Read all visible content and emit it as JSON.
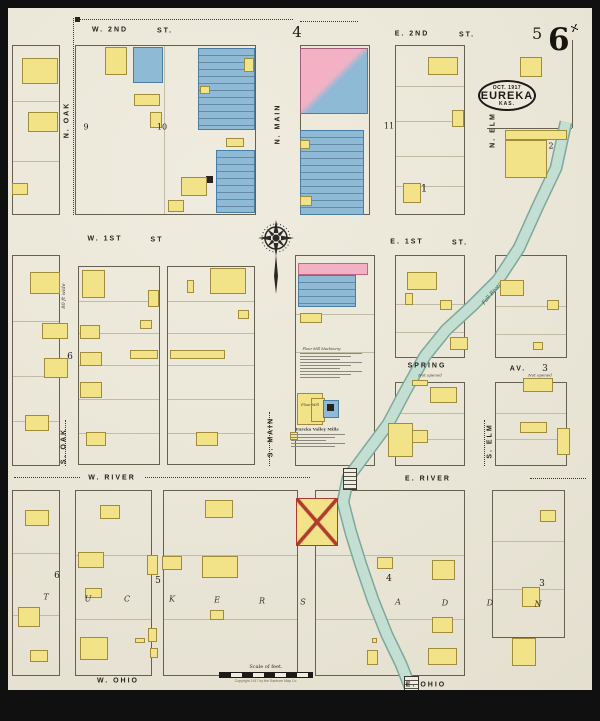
{
  "map": {
    "title_stamp": {
      "date": "OCT. 1917",
      "city": "EUREKA",
      "state": "KAS."
    },
    "sheet_number_large": "6",
    "adjacent_sheet_number": "5",
    "scale_label": "Scale of feet.",
    "copyright_line": "Copyright 1917 by the Sanborn Map Co.",
    "colors": {
      "paper": "#e9e5d6",
      "frame": "#101010",
      "frame_building": "#f2e388",
      "stone_building": "#8fbad5",
      "brick_building": "#f2b1c4",
      "river": "#c3ded2",
      "river_edge": "#7ea89a",
      "ink": "#25221b"
    },
    "streets": [
      {
        "t": "W. 2ND",
        "x": 110,
        "y": 30
      },
      {
        "t": "ST.",
        "x": 165,
        "y": 31
      },
      {
        "t": "E. 2ND",
        "x": 412,
        "y": 34
      },
      {
        "t": "ST.",
        "x": 467,
        "y": 35
      },
      {
        "t": "W. 1ST",
        "x": 105,
        "y": 239
      },
      {
        "t": "ST",
        "x": 157,
        "y": 240
      },
      {
        "t": "E. 1ST",
        "x": 407,
        "y": 242
      },
      {
        "t": "ST.",
        "x": 460,
        "y": 243
      },
      {
        "t": "SPRING",
        "x": 427,
        "y": 366
      },
      {
        "t": "AV.",
        "x": 518,
        "y": 369
      },
      {
        "t": "W. RIVER",
        "x": 112,
        "y": 478
      },
      {
        "t": "E. RIVER",
        "x": 428,
        "y": 479
      },
      {
        "t": "W. OHIO",
        "x": 118,
        "y": 681
      },
      {
        "t": "E. OHIO",
        "x": 426,
        "y": 685
      },
      {
        "t": "N. OAK",
        "x": 67,
        "y": 120,
        "v": 1
      },
      {
        "t": "N. MAIN",
        "x": 278,
        "y": 124,
        "v": 1
      },
      {
        "t": "N. ELM",
        "x": 493,
        "y": 130,
        "v": 1
      },
      {
        "t": "S. OAK",
        "x": 64,
        "y": 446,
        "v": 1
      },
      {
        "t": "S. MAIN",
        "x": 271,
        "y": 437,
        "v": 1
      },
      {
        "t": "S. ELM",
        "x": 490,
        "y": 441,
        "v": 1
      }
    ],
    "block_numbers": [
      {
        "t": "4",
        "x": 297,
        "y": 32,
        "s": 15
      },
      {
        "t": "9",
        "x": 86,
        "y": 127,
        "s": 8
      },
      {
        "t": "10",
        "x": 162,
        "y": 127,
        "s": 8
      },
      {
        "t": "11",
        "x": 389,
        "y": 126,
        "s": 8
      },
      {
        "t": "2",
        "x": 551,
        "y": 146,
        "s": 8
      },
      {
        "t": "1",
        "x": 424,
        "y": 189,
        "s": 10
      },
      {
        "t": "6",
        "x": 70,
        "y": 357,
        "s": 9
      },
      {
        "t": "3",
        "x": 545,
        "y": 369,
        "s": 9
      },
      {
        "t": "6",
        "x": 57,
        "y": 576,
        "s": 9
      },
      {
        "t": "5",
        "x": 158,
        "y": 581,
        "s": 9
      },
      {
        "t": "4",
        "x": 389,
        "y": 579,
        "s": 9
      },
      {
        "t": "3",
        "x": 542,
        "y": 584,
        "s": 9
      }
    ],
    "addition_letters": [
      {
        "t": "T",
        "x": 46,
        "y": 597
      },
      {
        "t": "U",
        "x": 88,
        "y": 599
      },
      {
        "t": "C",
        "x": 127,
        "y": 599
      },
      {
        "t": "K",
        "x": 172,
        "y": 599
      },
      {
        "t": "E",
        "x": 217,
        "y": 600
      },
      {
        "t": "R",
        "x": 262,
        "y": 601
      },
      {
        "t": "S",
        "x": 303,
        "y": 602
      },
      {
        "t": "A",
        "x": 398,
        "y": 602
      },
      {
        "t": "D",
        "x": 445,
        "y": 603
      },
      {
        "t": "D",
        "x": 490,
        "y": 603
      },
      {
        "t": "N",
        "x": 538,
        "y": 604
      }
    ],
    "annotations": [
      {
        "t": "80 ft wide",
        "x": 64,
        "y": 296,
        "s": 5,
        "i": 1,
        "v": 1
      },
      {
        "t": "Not opened",
        "x": 430,
        "y": 375,
        "s": 4,
        "i": 1
      },
      {
        "t": "Not opened",
        "x": 540,
        "y": 375,
        "s": 4,
        "i": 1
      },
      {
        "t": "Fall River",
        "x": 492,
        "y": 294,
        "s": 5.5,
        "i": 1,
        "r": -50,
        "c": "#3f5f56"
      },
      {
        "t": "Eureka Valley Mills",
        "x": 317,
        "y": 429,
        "s": 4,
        "b": 1
      },
      {
        "t": "Flour Mill",
        "x": 310,
        "y": 405,
        "s": 3.5,
        "i": 1
      },
      {
        "t": "Flour Mill Machinery:",
        "x": 322,
        "y": 349,
        "s": 3.5,
        "i": 1
      }
    ],
    "blocks": [
      {
        "x": 12,
        "y": 45,
        "w": 48,
        "h": 170,
        "rows": [
          55,
          115
        ]
      },
      {
        "x": 75,
        "y": 45,
        "w": 181,
        "h": 170,
        "rows": [],
        "cols": [
          88
        ]
      },
      {
        "x": 300,
        "y": 45,
        "w": 70,
        "h": 170,
        "rows": []
      },
      {
        "x": 395,
        "y": 45,
        "w": 70,
        "h": 170,
        "rows": [
          40,
          75,
          110,
          140
        ]
      },
      {
        "x": 12,
        "y": 255,
        "w": 48,
        "h": 211,
        "rows": [
          65,
          120,
          165
        ]
      },
      {
        "x": 78,
        "y": 266,
        "w": 82,
        "h": 199,
        "rows": [
          34,
          66,
          98,
          132,
          166
        ]
      },
      {
        "x": 167,
        "y": 266,
        "w": 88,
        "h": 199,
        "rows": [
          34,
          66,
          98,
          132,
          166
        ]
      },
      {
        "x": 295,
        "y": 255,
        "w": 80,
        "h": 211,
        "rows": [
          58,
          96
        ]
      },
      {
        "x": 395,
        "y": 255,
        "w": 70,
        "h": 103,
        "rows": [
          48,
          76
        ]
      },
      {
        "x": 495,
        "y": 255,
        "w": 72,
        "h": 103,
        "rows": [
          50,
          78
        ]
      },
      {
        "x": 395,
        "y": 382,
        "w": 70,
        "h": 84,
        "rows": [
          30,
          56
        ]
      },
      {
        "x": 495,
        "y": 382,
        "w": 72,
        "h": 84,
        "rows": [
          30,
          56
        ]
      },
      {
        "x": 12,
        "y": 490,
        "w": 48,
        "h": 186,
        "rows": [
          62,
          124
        ]
      },
      {
        "x": 75,
        "y": 490,
        "w": 77,
        "h": 186,
        "rows": [
          64,
          128
        ]
      },
      {
        "x": 163,
        "y": 490,
        "w": 135,
        "h": 186,
        "rows": [
          64,
          128
        ]
      },
      {
        "x": 315,
        "y": 490,
        "w": 150,
        "h": 186,
        "rows": [
          64,
          128
        ]
      },
      {
        "x": 492,
        "y": 490,
        "w": 73,
        "h": 148,
        "rows": [
          50,
          98
        ]
      }
    ],
    "solid_lines": [
      [
        487,
        128,
        572,
        128
      ],
      [
        572,
        40,
        572,
        128
      ]
    ],
    "dotted_lines": [
      [
        73,
        18,
        73,
        215
      ],
      [
        75,
        19,
        293,
        19
      ],
      [
        300,
        21,
        358,
        21
      ],
      [
        14,
        477,
        80,
        477
      ],
      [
        145,
        477,
        310,
        477
      ],
      [
        530,
        478,
        586,
        478
      ],
      [
        65,
        420,
        65,
        466
      ],
      [
        269,
        412,
        269,
        466
      ],
      [
        484,
        420,
        484,
        466
      ]
    ],
    "buildings": [
      [
        22,
        58,
        36,
        26,
        "y"
      ],
      [
        28,
        112,
        30,
        20,
        "y"
      ],
      [
        12,
        183,
        16,
        12,
        "y"
      ],
      [
        105,
        47,
        22,
        28,
        "y"
      ],
      [
        133,
        47,
        30,
        36,
        "b",
        "x"
      ],
      [
        134,
        94,
        26,
        12,
        "y"
      ],
      [
        150,
        112,
        12,
        16,
        "y"
      ],
      [
        198,
        48,
        57,
        82,
        "b",
        "l"
      ],
      [
        200,
        86,
        10,
        8,
        "y"
      ],
      [
        244,
        58,
        10,
        14,
        "y"
      ],
      [
        216,
        150,
        39,
        63,
        "b",
        "l"
      ],
      [
        206,
        176,
        7,
        7,
        "k"
      ],
      [
        181,
        177,
        26,
        19,
        "y"
      ],
      [
        168,
        200,
        16,
        12,
        "y"
      ],
      [
        226,
        138,
        18,
        9,
        "y"
      ],
      [
        300,
        48,
        68,
        66,
        "p",
        "s"
      ],
      [
        300,
        130,
        64,
        85,
        "b",
        "l"
      ],
      [
        300,
        140,
        10,
        9,
        "y"
      ],
      [
        300,
        196,
        12,
        10,
        "y"
      ],
      [
        428,
        57,
        30,
        18,
        "y"
      ],
      [
        452,
        110,
        12,
        17,
        "y"
      ],
      [
        403,
        183,
        18,
        20,
        "y"
      ],
      [
        520,
        57,
        22,
        20,
        "y"
      ],
      [
        505,
        130,
        62,
        10,
        "y"
      ],
      [
        505,
        140,
        42,
        38,
        "y",
        "x"
      ],
      [
        75,
        17,
        5,
        5,
        "k"
      ],
      [
        30,
        272,
        30,
        22,
        "y"
      ],
      [
        42,
        323,
        26,
        16,
        "y"
      ],
      [
        44,
        358,
        24,
        20,
        "y"
      ],
      [
        25,
        415,
        24,
        16,
        "y"
      ],
      [
        82,
        270,
        23,
        28,
        "y"
      ],
      [
        80,
        325,
        20,
        14,
        "y"
      ],
      [
        80,
        352,
        22,
        14,
        "y"
      ],
      [
        80,
        382,
        22,
        16,
        "y"
      ],
      [
        86,
        432,
        20,
        14,
        "y"
      ],
      [
        148,
        290,
        11,
        17,
        "y",
        "x"
      ],
      [
        130,
        350,
        28,
        9,
        "y"
      ],
      [
        140,
        320,
        12,
        9,
        "y"
      ],
      [
        210,
        268,
        36,
        26,
        "y"
      ],
      [
        187,
        280,
        7,
        13,
        "y"
      ],
      [
        170,
        350,
        55,
        9,
        "y"
      ],
      [
        196,
        432,
        22,
        14,
        "y"
      ],
      [
        238,
        310,
        11,
        9,
        "y"
      ],
      [
        298,
        263,
        70,
        12,
        "p"
      ],
      [
        298,
        275,
        58,
        32,
        "b",
        "l"
      ],
      [
        300,
        313,
        22,
        10,
        "y"
      ],
      [
        297,
        393,
        26,
        32,
        "y"
      ],
      [
        311,
        398,
        14,
        24,
        "y"
      ],
      [
        323,
        400,
        16,
        18,
        "b"
      ],
      [
        327,
        404,
        7,
        7,
        "k"
      ],
      [
        290,
        432,
        8,
        8,
        "y"
      ],
      [
        407,
        272,
        30,
        18,
        "y"
      ],
      [
        405,
        293,
        8,
        12,
        "y"
      ],
      [
        450,
        337,
        18,
        13,
        "y"
      ],
      [
        440,
        300,
        12,
        10,
        "y"
      ],
      [
        500,
        280,
        24,
        16,
        "y"
      ],
      [
        547,
        300,
        12,
        10,
        "y"
      ],
      [
        533,
        342,
        10,
        8,
        "y"
      ],
      [
        412,
        380,
        16,
        6,
        "y"
      ],
      [
        430,
        387,
        27,
        16,
        "y"
      ],
      [
        408,
        430,
        20,
        13,
        "y"
      ],
      [
        388,
        423,
        25,
        34,
        "y",
        "x"
      ],
      [
        523,
        378,
        30,
        14,
        "y"
      ],
      [
        520,
        422,
        27,
        11,
        "y"
      ],
      [
        557,
        428,
        13,
        27,
        "y"
      ],
      [
        18,
        607,
        22,
        20,
        "y"
      ],
      [
        25,
        510,
        24,
        16,
        "y"
      ],
      [
        30,
        650,
        18,
        12,
        "y"
      ],
      [
        100,
        505,
        20,
        14,
        "y"
      ],
      [
        78,
        552,
        26,
        16,
        "y"
      ],
      [
        147,
        555,
        11,
        20,
        "y"
      ],
      [
        85,
        588,
        17,
        10,
        "y"
      ],
      [
        80,
        637,
        28,
        23,
        "y"
      ],
      [
        135,
        638,
        10,
        5,
        "y"
      ],
      [
        148,
        628,
        9,
        14,
        "y",
        "x"
      ],
      [
        150,
        648,
        8,
        10,
        "y"
      ],
      [
        205,
        500,
        28,
        18,
        "y"
      ],
      [
        162,
        556,
        20,
        14,
        "y"
      ],
      [
        202,
        556,
        36,
        22,
        "y"
      ],
      [
        210,
        610,
        14,
        10,
        "y"
      ],
      [
        296,
        498,
        42,
        48,
        "y",
        "r"
      ],
      [
        377,
        557,
        16,
        12,
        "y"
      ],
      [
        432,
        560,
        23,
        20,
        "y"
      ],
      [
        432,
        617,
        21,
        16,
        "y"
      ],
      [
        428,
        648,
        29,
        17,
        "y"
      ],
      [
        367,
        650,
        11,
        15,
        "y",
        "x"
      ],
      [
        372,
        638,
        5,
        5,
        "y"
      ],
      [
        540,
        510,
        16,
        12,
        "y"
      ],
      [
        522,
        587,
        18,
        20,
        "y"
      ],
      [
        512,
        638,
        24,
        28,
        "y"
      ]
    ],
    "river": {
      "width": 12,
      "points": [
        [
          566,
          122
        ],
        [
          556,
          168
        ],
        [
          538,
          206
        ],
        [
          519,
          248
        ],
        [
          498,
          280
        ],
        [
          472,
          306
        ],
        [
          446,
          330
        ],
        [
          425,
          356
        ],
        [
          406,
          390
        ],
        [
          388,
          424
        ],
        [
          365,
          455
        ],
        [
          348,
          478
        ],
        [
          343,
          502
        ],
        [
          351,
          533
        ],
        [
          361,
          565
        ],
        [
          373,
          600
        ],
        [
          387,
          635
        ],
        [
          401,
          664
        ],
        [
          412,
          692
        ],
        [
          416,
          708
        ]
      ]
    },
    "bridges": [
      {
        "x": 343,
        "y": 468,
        "w": 14,
        "h": 22
      },
      {
        "x": 404,
        "y": 676,
        "w": 15,
        "h": 18
      }
    ],
    "notes": [
      {
        "x": 300,
        "y": 353,
        "w": 62,
        "n": 9
      },
      {
        "x": 291,
        "y": 434,
        "w": 54,
        "n": 5
      }
    ],
    "compass": {
      "x": 276,
      "y": 238
    }
  }
}
